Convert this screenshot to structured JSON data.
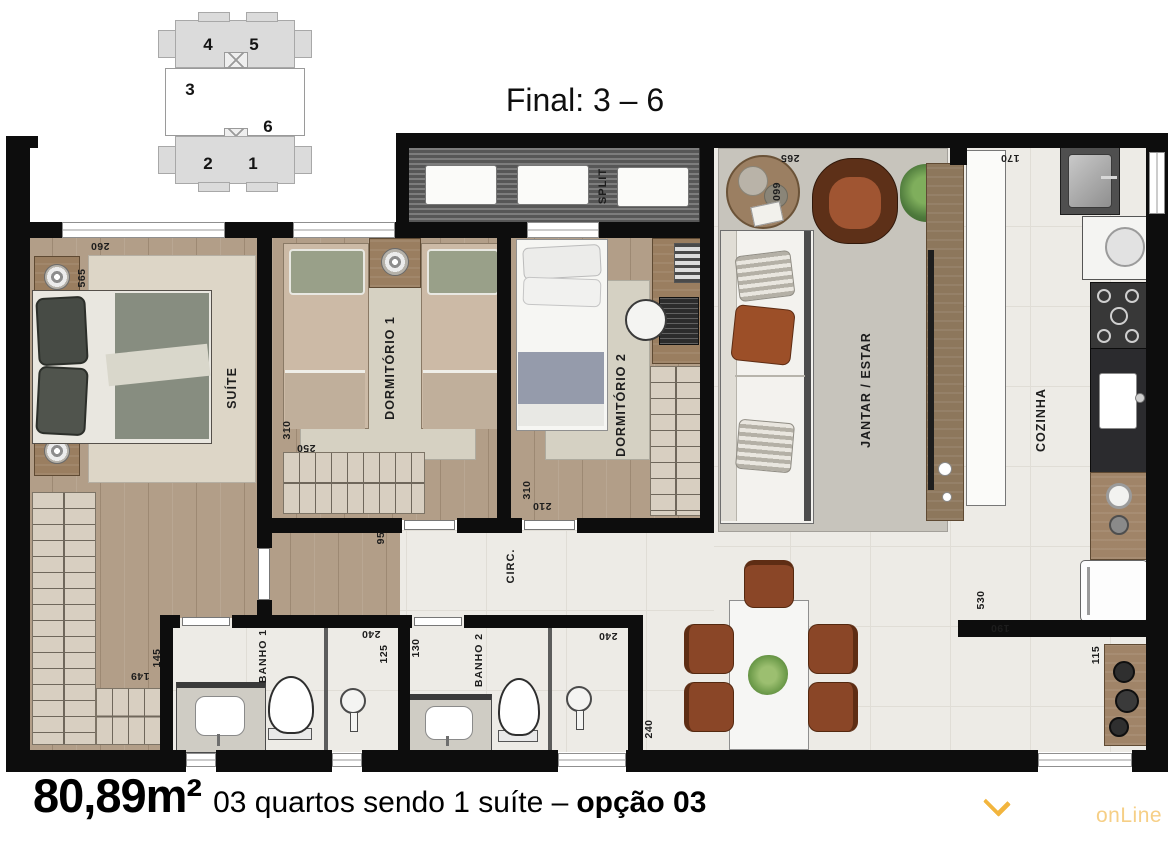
{
  "header": {
    "title": "Final: 3 – 6"
  },
  "keyplan": {
    "units": [
      "4",
      "5",
      "3",
      "6",
      "2",
      "1"
    ]
  },
  "rooms": {
    "suite": "SUÍTE",
    "dorm1": "DORMITÓRIO 1",
    "dorm2": "DORMITÓRIO 2",
    "split": "SPLIT",
    "living": "JANTAR / ESTAR",
    "kitchen": "COZINHA",
    "circ": "CIRC.",
    "banho1": "BANHO 1",
    "banho2": "BANHO 2"
  },
  "dims": {
    "suite_width": "260",
    "suite_depth": "565",
    "suite_closet_a": "149",
    "suite_closet_b": "145",
    "dorm1_depth": "310",
    "dorm1_width": "250",
    "dorm2_depth": "310",
    "dorm2_width": "210",
    "hall_width": "95",
    "living_width": "265",
    "living_depth": "660",
    "kitchen_width": "170",
    "kitchen_depth": "530",
    "kitchen_pass": "190",
    "counter_depth": "115",
    "dining_width": "240",
    "banho1_depth": "240",
    "banho1_width": "125",
    "banho2_width": "130",
    "banho2_depth": "240"
  },
  "footer": {
    "area": "80,89m²",
    "description": "03 quartos sendo 1 suíte –",
    "option": "opção 03"
  },
  "watermark": {
    "text": "onLine"
  },
  "colors": {
    "walls": "#0d0d0d",
    "accent_chevron": "#f2b53e",
    "watermark_text": "#f6cf86"
  }
}
